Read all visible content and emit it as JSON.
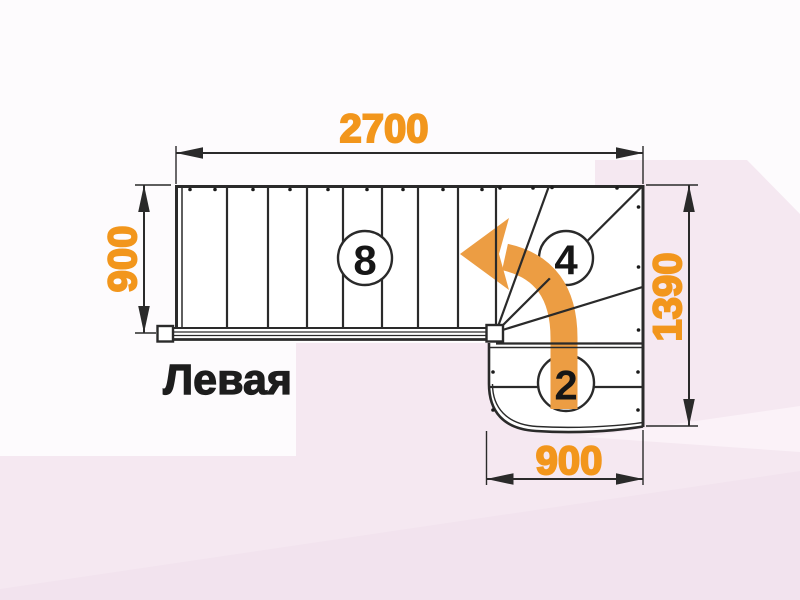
{
  "drawing": {
    "title": "Левая",
    "dimensions": {
      "top": "2700",
      "left": "900",
      "right": "1390",
      "bottom": "900"
    },
    "step_counts": {
      "straight_flight": "8",
      "winder_steps": "4",
      "lower_flight": "2"
    }
  },
  "colors": {
    "dimension_text": "#f2961c",
    "arrow_orange": "#ec9d43",
    "line_dark": "#2a2a2a",
    "digit": "#161616",
    "title": "#1d1d1d",
    "background_base": "#fdfbfd",
    "background_pink": "#f5e8f1",
    "background_pink_dark": "#f2e3ee",
    "background_pink_light": "#fbf2f8",
    "tread_fill": "#ffffff"
  }
}
